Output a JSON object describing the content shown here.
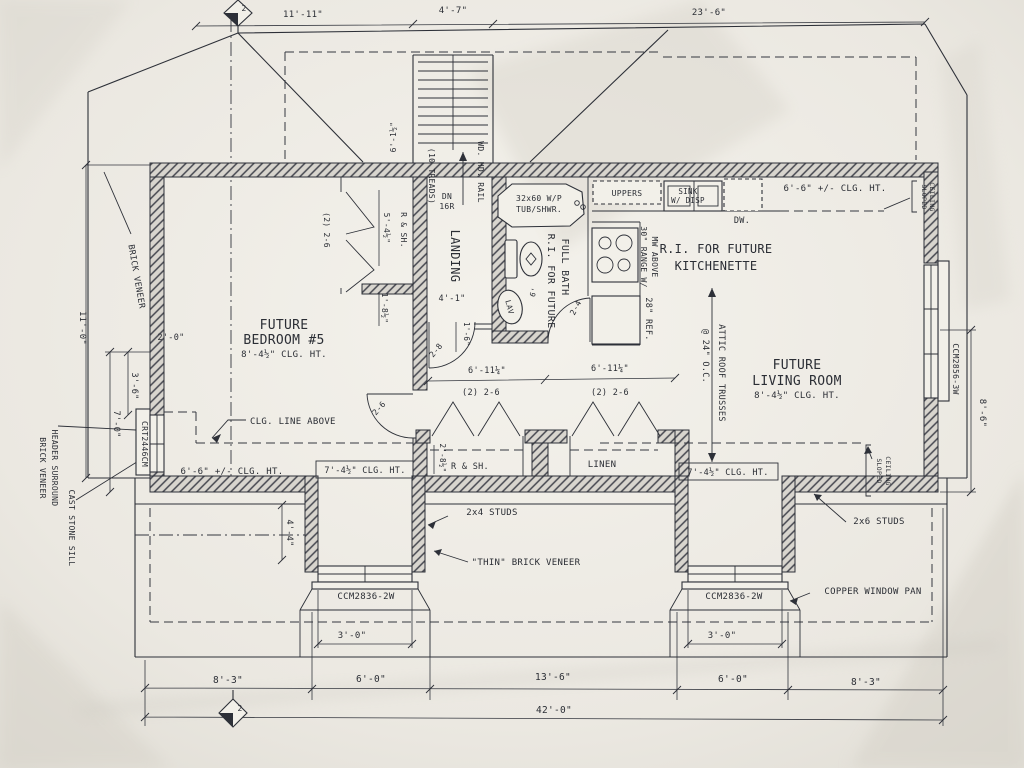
{
  "dims_top": {
    "left": "11'-11\"",
    "stair": "4'-7\"",
    "right": "23'-6\""
  },
  "stairs": {
    "treads": "(10 TREADS)",
    "rail": "WD. HD. RAIL",
    "down_line1": "DN",
    "down_line2": "16R",
    "width_dim": "6'-1½\""
  },
  "rooms": {
    "bedroom": {
      "line1": "FUTURE",
      "line2": "BEDROOM #5",
      "ceiling": "8'-4½\" CLG. HT."
    },
    "landing": {
      "name": "LANDING",
      "width": "4'-1\""
    },
    "bath": {
      "line1": "R.I. FOR FUTURE",
      "line2": "FULL BATH",
      "tub_line1": "32x60 W/P",
      "tub_line2": "TUB/SHWR.",
      "lav": "LAV",
      "small_dim": "6'"
    },
    "kitchenette": {
      "line1": "R.I. FOR FUTURE",
      "line2": "KITCHENETTE",
      "uppers": "UPPERS",
      "sink_line1": "SINK",
      "sink_line2": "W/ DISP",
      "dw": "DW.",
      "range_line1": "30\" RANGE W/",
      "range_line2": "MW ABOVE",
      "ref": "28\" REF.",
      "ceiling": "6'-6\" +/- CLG. HT."
    },
    "living": {
      "line1": "FUTURE",
      "line2": "LIVING ROOM",
      "ceiling": "8'-4½\" CLG. HT."
    }
  },
  "attic_note": {
    "line1": "ATTIC ROOF TRUSSES",
    "line2": "@ 24\" O.C."
  },
  "closets": {
    "bedroom_closet": {
      "door": "(2) 2-6",
      "depth": "5'-4½\"",
      "shelf": "R & SH.",
      "offset": "1'-8½\""
    },
    "hall_closet": {
      "door": "(2) 2-6",
      "width": "6'-11¼\"",
      "shelf": "R & SH.",
      "depth": "2'-8½\""
    },
    "linen": {
      "door": "(2) 2-6",
      "width": "6'-11¼\"",
      "name": "LINEN"
    }
  },
  "doors": {
    "bedroom": "2-6",
    "hall": "2-8",
    "bath": "2-4"
  },
  "ceiling_notes": {
    "line_above": "CLG. LINE ABOVE",
    "left_low": "6'-6\" +/- CLG. HT.",
    "left_mid": "7'-4½\" CLG. HT.",
    "right_mid": "7'-4½\" CLG. HT.",
    "sloped_line1": "SLOPED",
    "sloped_line2": "CEILING"
  },
  "windows": {
    "left": "CRT2446CM",
    "right": "CCM2856-3W",
    "dormer_left": "CCM2836-2W",
    "dormer_right": "CCM2836-2W"
  },
  "wall_notes": {
    "brick_veneer": "BRICK VENEER",
    "header_line1": "BRICK VENEER",
    "header_line2": "HEADER SURROUND",
    "sill": "CAST STONE SILL",
    "studs_2x4": "2x4 STUDS",
    "thin_brick": "\"THIN\" BRICK VENEER",
    "studs_2x6": "2x6 STUDS",
    "copper_pan": "COPPER WINDOW PAN"
  },
  "dims_left": {
    "notch": "2'-0\"",
    "total": "11'-0\"",
    "upper": "3'-6\"",
    "lower": "7'-0\""
  },
  "dims_right": {
    "window": "8'-6\""
  },
  "dims_misc": {
    "hall": "1'-6\"",
    "dormer_height": "4'-4\"",
    "dormer_left_width": "3'-0\"",
    "dormer_right_width": "3'-0\""
  },
  "dims_bottom": {
    "d1": "8'-3\"",
    "d2": "6'-0\"",
    "d3": "13'-6\"",
    "d4": "6'-0\"",
    "d5": "8'-3\"",
    "total": "42'-0\""
  },
  "markers": {
    "section_top": "2",
    "section_bottom": "2"
  },
  "colors": {
    "paper": "#e9e6e0",
    "ink": "#2d3038"
  }
}
